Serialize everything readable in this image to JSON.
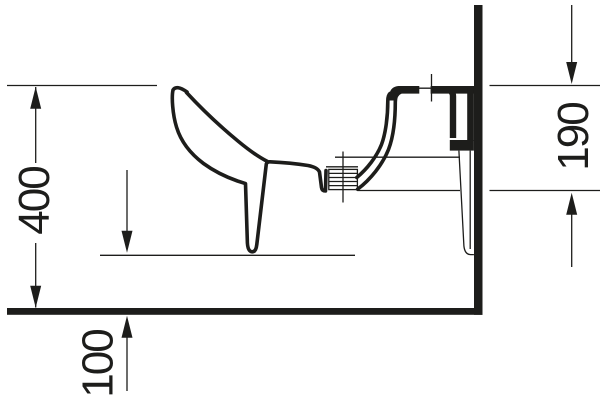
{
  "colors": {
    "ink": "#1d1d1b",
    "background": "#ffffff"
  },
  "dimensions": {
    "overall_height": "400",
    "wall_fixing_height": "190",
    "floor_clearance": "100"
  }
}
